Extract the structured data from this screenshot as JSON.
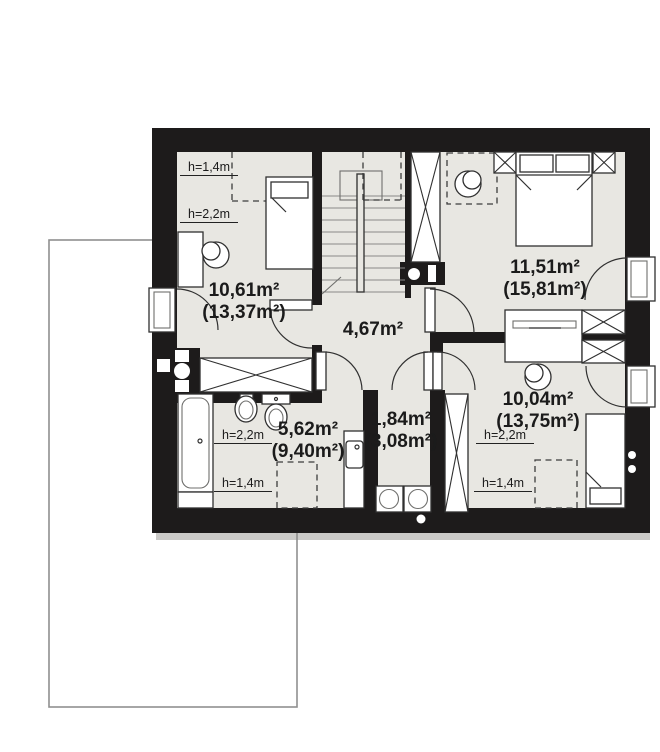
{
  "plan": {
    "type": "attic-floor-plan",
    "rooms": [
      {
        "name": "bedroom-top-left",
        "area": "10,61m²",
        "area_total": "(13,37m²)"
      },
      {
        "name": "bedroom-top-right",
        "area": "11,51m²",
        "area_total": "(15,81m²)"
      },
      {
        "name": "hall",
        "area": "4,67m²",
        "area_total": ""
      },
      {
        "name": "bedroom-bottom-right",
        "area": "10,04m²",
        "area_total": "(13,75m²)"
      },
      {
        "name": "bathroom",
        "area": "5,62m²",
        "area_total": "(9,40m²)"
      },
      {
        "name": "laundry",
        "area": "1,84m²",
        "area_total": "(3,08m²)"
      }
    ],
    "height_marks": [
      {
        "room": "bedroom-top-left",
        "text": "h=1,4m"
      },
      {
        "room": "bedroom-top-left",
        "text": "h=2,2m"
      },
      {
        "room": "bathroom",
        "text": "h=2,2m"
      },
      {
        "room": "bathroom",
        "text": "h=1,4m"
      },
      {
        "room": "bedroom-bottom-right",
        "text": "h=2,2m"
      },
      {
        "room": "bedroom-bottom-right",
        "text": "h=1,4m"
      }
    ],
    "colors": {
      "wall": "#1d1b1b",
      "floor": "#e8e7e2",
      "furniture_stroke": "#303030",
      "ground_outline": "#8f8f8f",
      "shadow": "#cbcac8"
    }
  }
}
